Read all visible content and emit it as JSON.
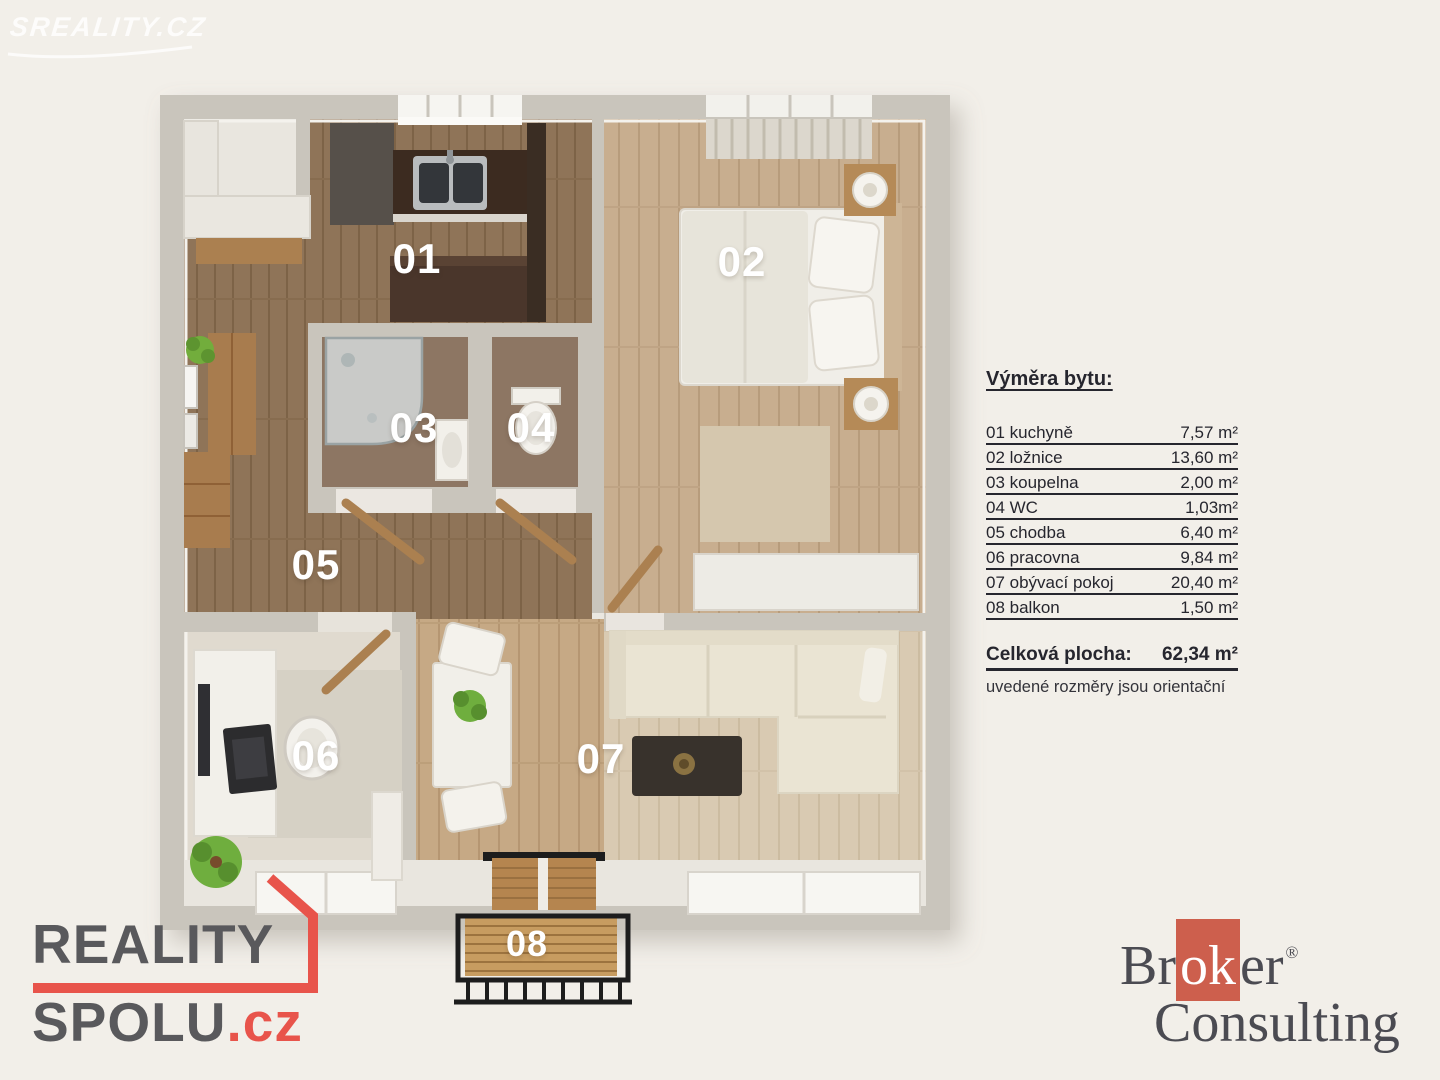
{
  "watermark": {
    "text": "Sreality.cz"
  },
  "rooms": [
    {
      "number": "01",
      "label": "01 kuchyně",
      "area": "7,57 m²"
    },
    {
      "number": "02",
      "label": "02 ložnice",
      "area": "13,60 m²"
    },
    {
      "number": "03",
      "label": "03 koupelna",
      "area": "2,00 m²"
    },
    {
      "number": "04",
      "label": "04 WC",
      "area": "1,03m²"
    },
    {
      "number": "05",
      "label": "05 chodba",
      "area": "6,40 m²"
    },
    {
      "number": "06",
      "label": "06 pracovna",
      "area": "9,84 m²"
    },
    {
      "number": "07",
      "label": "07 obývací pokoj",
      "area": "20,40 m²"
    },
    {
      "number": "08",
      "label": "08 balkon",
      "area": "1,50 m²"
    }
  ],
  "legend": {
    "title": "Výměra bytu:",
    "total_label": "Celková plocha:",
    "total_value": "62,34 m²",
    "note": "uvedené rozměry jsou orientační"
  },
  "logos": {
    "reality_spolu": {
      "line1": "REALITY",
      "line2": "SPOLU",
      "tld": ".cz"
    },
    "broker": {
      "part1": "Br",
      "part2": "ok",
      "part3": "er",
      "reg": "®",
      "line2": "Consulting"
    }
  },
  "colors": {
    "background": "#f2efe9",
    "wall": "#c9c5bc",
    "accent_red": "#e8544b",
    "broker_red": "#cd5f4d",
    "logo_gray": "#59595c",
    "text_dark": "#26262e"
  }
}
